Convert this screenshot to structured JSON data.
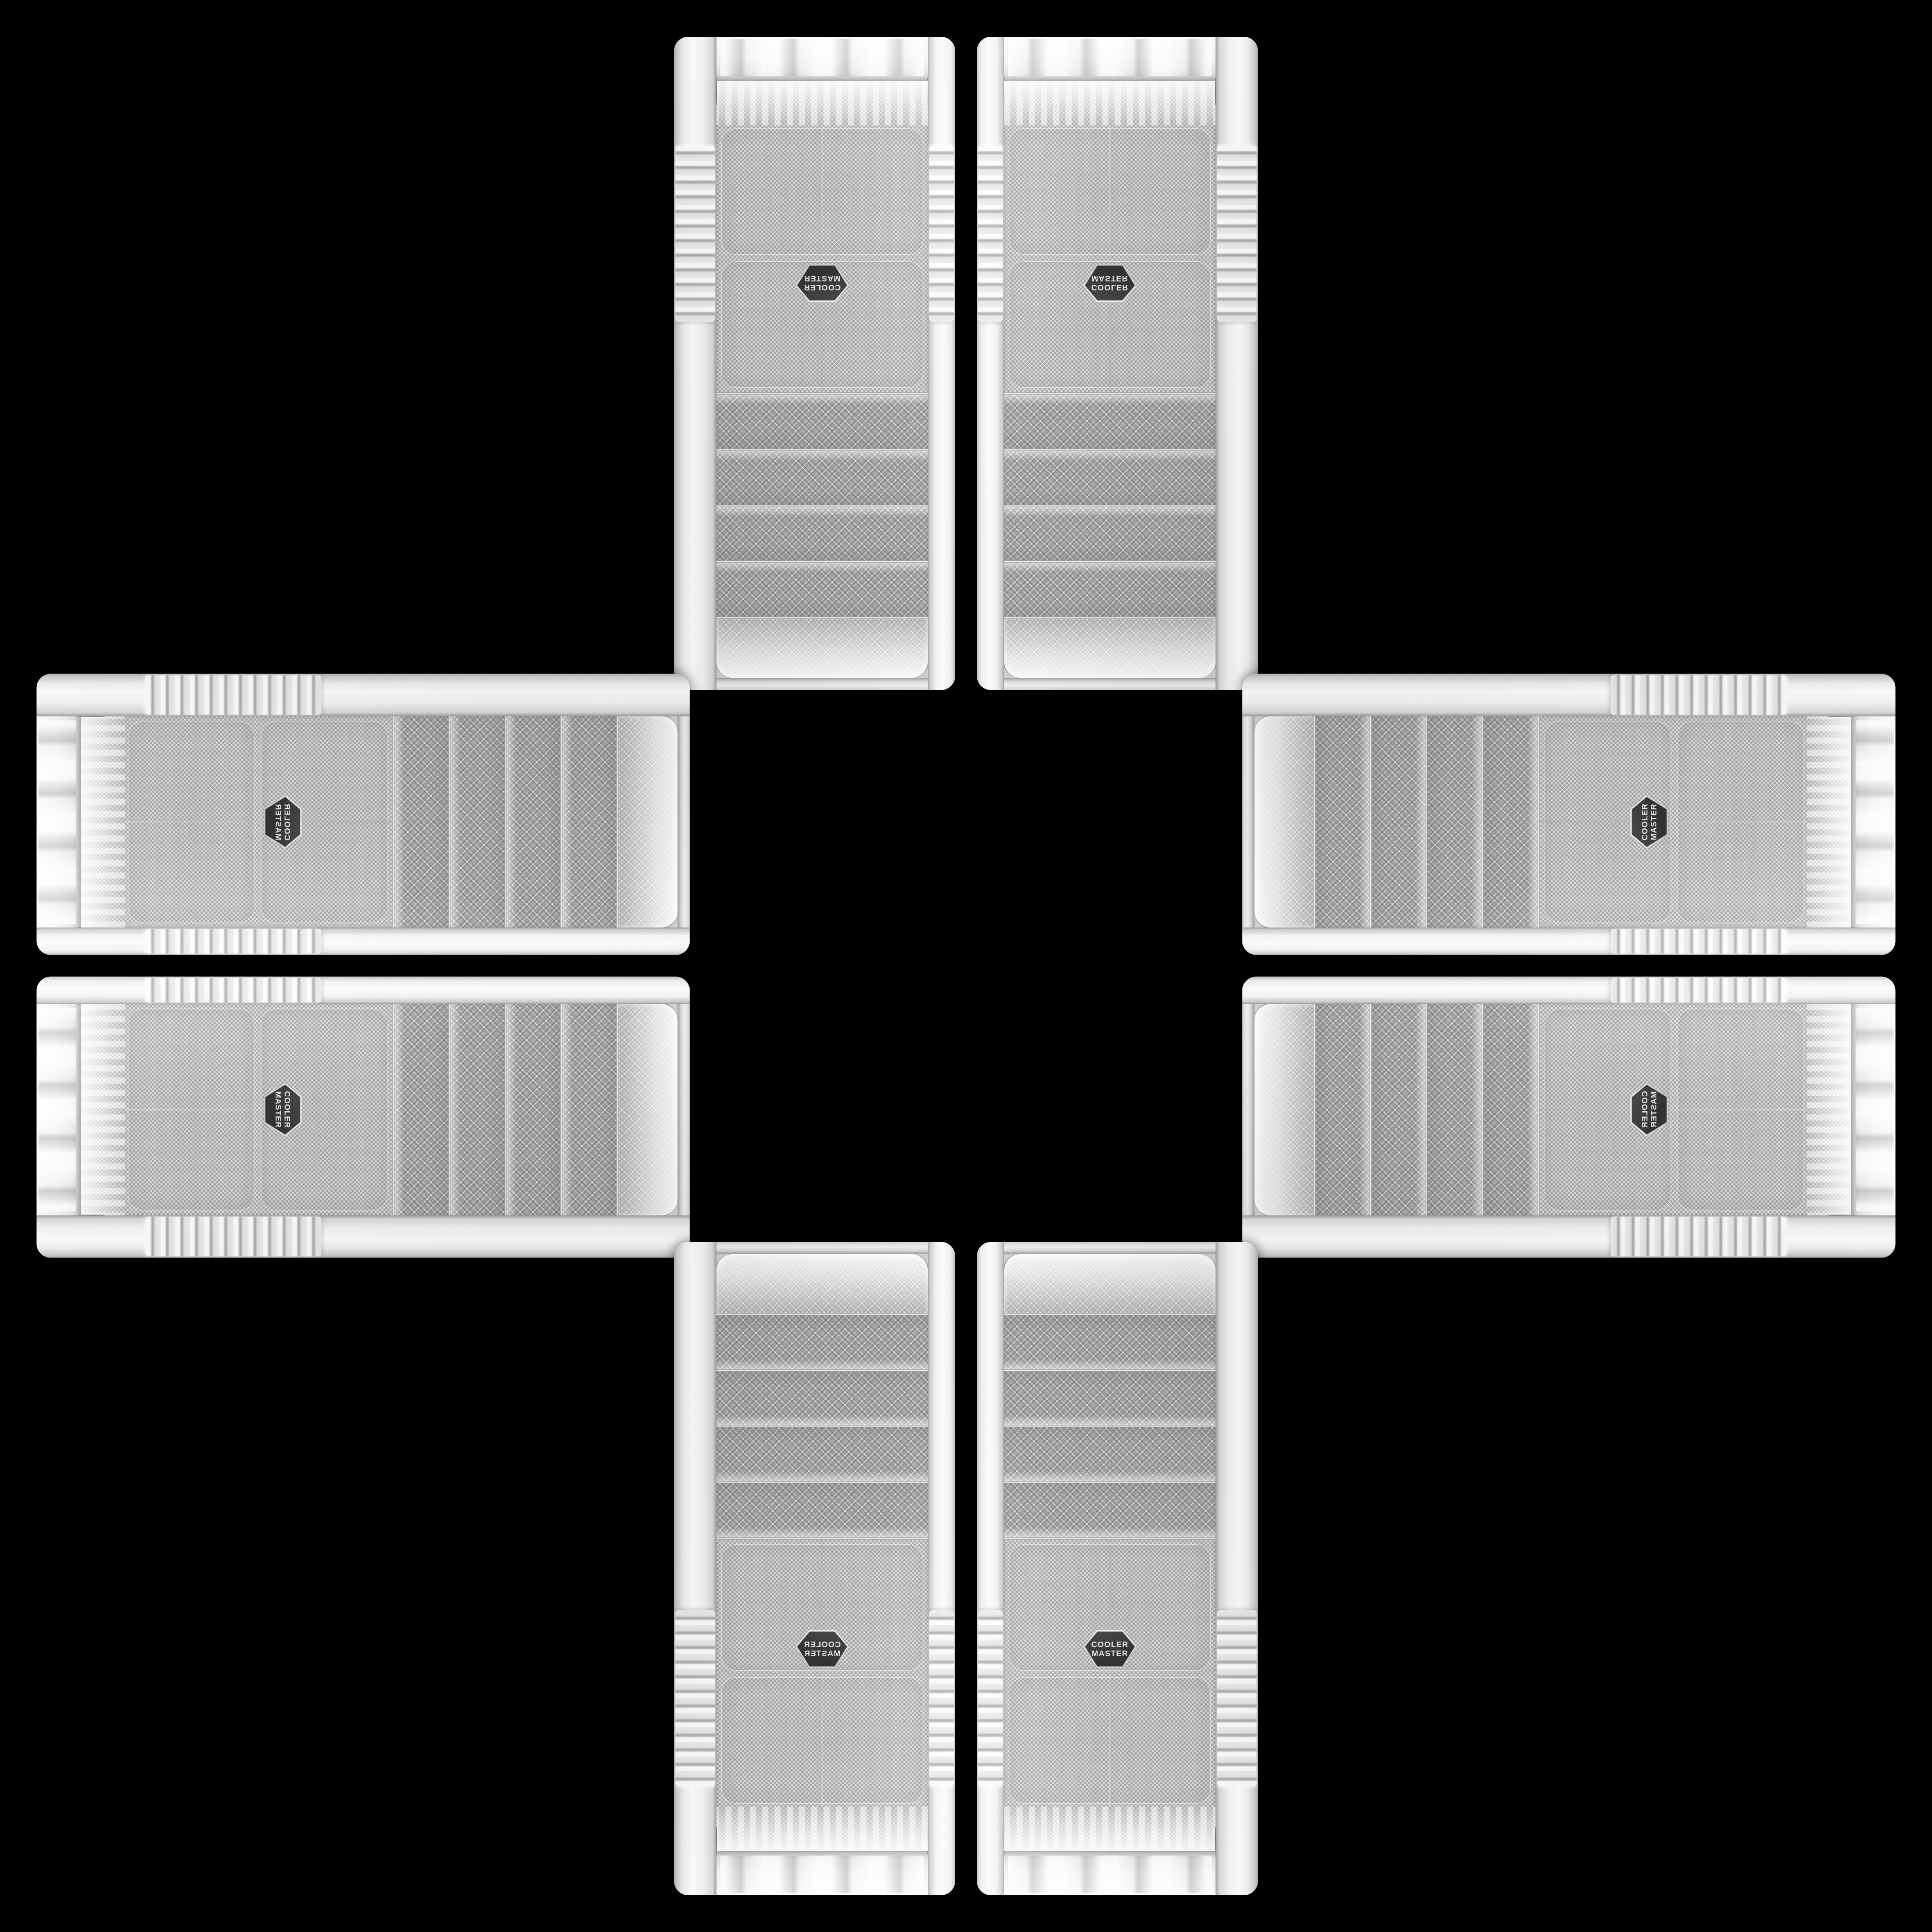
{
  "scene": {
    "type": "product-collage",
    "background_color": "#000000",
    "description": "Eight white Cooler Master PC case front panels arranged in a plus / cross pattern on a black background, mirrored and rotated around an empty center",
    "panels": [
      {
        "id": "top-left",
        "arm": "top",
        "position": "left",
        "orientation": "vertical"
      },
      {
        "id": "top-right",
        "arm": "top",
        "position": "right",
        "orientation": "vertical"
      },
      {
        "id": "left-top",
        "arm": "left",
        "position": "top",
        "orientation": "horizontal"
      },
      {
        "id": "left-bottom",
        "arm": "left",
        "position": "bottom",
        "orientation": "horizontal"
      },
      {
        "id": "right-top",
        "arm": "right",
        "position": "top",
        "orientation": "horizontal"
      },
      {
        "id": "right-bottom",
        "arm": "right",
        "position": "bottom",
        "orientation": "horizontal"
      },
      {
        "id": "bottom-left",
        "arm": "bottom",
        "position": "left",
        "orientation": "vertical"
      },
      {
        "id": "bottom-right",
        "arm": "bottom",
        "position": "right",
        "orientation": "vertical"
      }
    ]
  },
  "logo": {
    "line1": "COOLER",
    "line2": "MASTER",
    "badge_color": "#3c3e3d",
    "text_color": "#e4e6e3"
  },
  "panel": {
    "bay_count": 4,
    "frame_color": "#ececec",
    "mesh_color": "#e5e5e5",
    "mesh_dot_color": "#a9aaa9",
    "seam_color": "#8e8e8e"
  }
}
